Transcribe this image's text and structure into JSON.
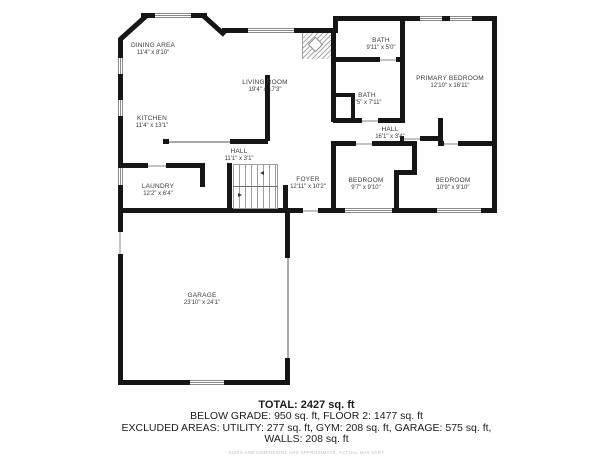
{
  "plan": {
    "rooms": [
      {
        "name": "DINING AREA",
        "dims": "11'4\" x 8'10\""
      },
      {
        "name": "LIVING ROOM",
        "dims": "19'4\" x 17'3\""
      },
      {
        "name": "KITCHEN",
        "dims": "11'4\" x 13'1\""
      },
      {
        "name": "HALL",
        "dims": "11'1\" x 3'1\""
      },
      {
        "name": "LAUNDRY",
        "dims": "12'2\" x 6'4\""
      },
      {
        "name": "FOYER",
        "dims": "12'11\" x 10'2\""
      },
      {
        "name": "BATH",
        "dims": "9'11\" x 5'0\""
      },
      {
        "name": "BATH",
        "dims": "7'5\" x 7'11\""
      },
      {
        "name": "PRIMARY BEDROOM",
        "dims": "12'10\" x 16'11\""
      },
      {
        "name": "HALL",
        "dims": "16'1\" x 3'4\""
      },
      {
        "name": "BEDROOM",
        "dims": "9'7\" x 9'10\""
      },
      {
        "name": "BEDROOM",
        "dims": "10'9\" x 9'10\""
      },
      {
        "name": "GARAGE",
        "dims": "23'10\" x 24'1\""
      }
    ],
    "summary": {
      "total": "TOTAL: 2427 sq. ft",
      "line2": "BELOW GRADE: 950 sq. ft, FLOOR 2: 1477 sq. ft",
      "line3": "EXCLUDED AREAS: UTILITY: 277 sq. ft, GYM: 208 sq. ft, GARAGE: 575 sq. ft,",
      "line4": "WALLS: 208 sq. ft",
      "disclaimer": "SIZES AND DIMENSIONS ARE APPROXIMATE, ACTUAL MAY VARY"
    },
    "colors": {
      "wall": "#161616",
      "window_line": "#8a8a8a",
      "room_text": "#3a3a3a",
      "summary_text": "#1c1c1c",
      "disclaimer_text": "#bfbfbf"
    }
  }
}
